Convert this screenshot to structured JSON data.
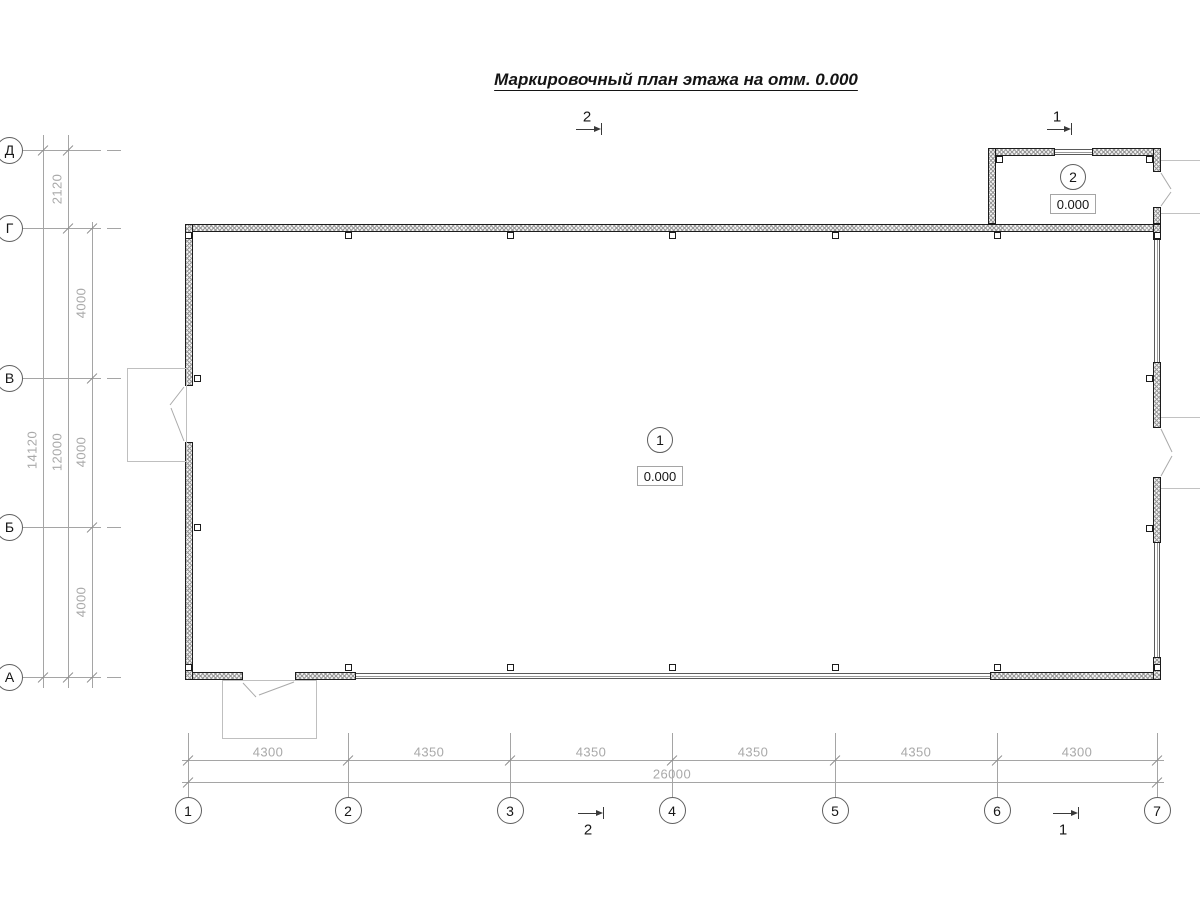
{
  "title": "Маркировочный план этажа на отм. 0.000",
  "section_markers": {
    "top": [
      "2",
      "1"
    ],
    "bottom": [
      "2",
      "1"
    ]
  },
  "grid": {
    "rows": [
      "Д",
      "Г",
      "В",
      "Б",
      "А"
    ],
    "cols": [
      "1",
      "2",
      "3",
      "4",
      "5",
      "6",
      "7"
    ]
  },
  "dimensions": {
    "left": {
      "segments": [
        "2120",
        "4000",
        "4000",
        "4000"
      ],
      "inner_total": "12000",
      "total": "14120"
    },
    "bottom": {
      "segments": [
        "4300",
        "4350",
        "4350",
        "4350",
        "4350",
        "4300"
      ],
      "total": "26000"
    }
  },
  "rooms": [
    {
      "number": "1",
      "elevation": "0.000"
    },
    {
      "number": "2",
      "elevation": "0.000"
    }
  ]
}
